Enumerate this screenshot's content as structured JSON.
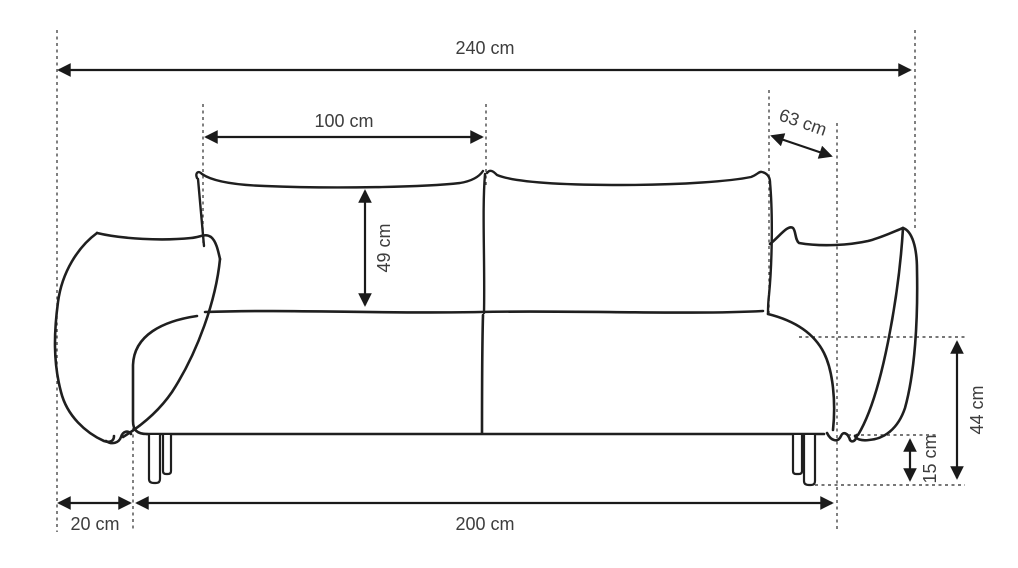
{
  "diagram": {
    "type": "furniture-dimension-drawing",
    "subject": "sofa front view with dimension lines",
    "unit": "cm",
    "background_color": "#ffffff",
    "line_color": "#1f1f1f",
    "guide_line_color": "#4a4a4a",
    "text_color": "#3d3d3d",
    "dimensions": {
      "total_width": {
        "label": "240 cm",
        "value": 240
      },
      "back_cushion_width": {
        "label": "100 cm",
        "value": 100
      },
      "depth": {
        "label": "63 cm",
        "value": 63
      },
      "back_cushion_height": {
        "label": "49 cm",
        "value": 49
      },
      "seat_height": {
        "label": "44 cm",
        "value": 44
      },
      "leg_height": {
        "label": "15 cm",
        "value": 15
      },
      "armrest_width": {
        "label": "20 cm",
        "value": 20
      },
      "seat_width": {
        "label": "200 cm",
        "value": 200
      }
    }
  }
}
